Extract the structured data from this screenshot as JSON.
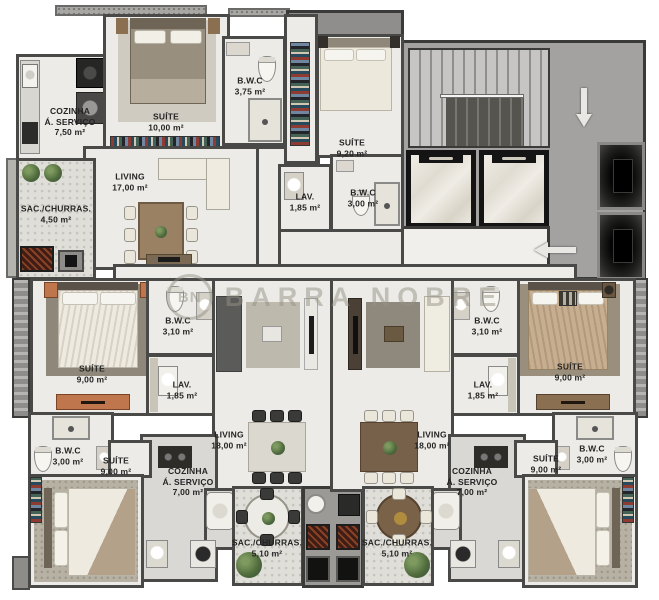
{
  "watermark": {
    "initials": "BN",
    "name": "BARRA NOBRE"
  },
  "rooms": {
    "a_cozinha": {
      "name": "COZINHA",
      "name2": "Á. SERVIÇO",
      "area": "7,50 m²"
    },
    "a_suite": {
      "name": "SUÍTE",
      "area": "10,00 m²"
    },
    "a_bwc": {
      "name": "B.W.C",
      "area": "3,75 m²"
    },
    "a_living": {
      "name": "LIVING",
      "area": "17,00 m²"
    },
    "a_sacada": {
      "name": "SAC./CHURRAS.",
      "area": "4,50 m²"
    },
    "b_suite": {
      "name": "SUÍTE",
      "area": "9,20 m²"
    },
    "b_lav": {
      "name": "LAV.",
      "area": "1,85 m²"
    },
    "b_bwc": {
      "name": "B.W.C",
      "area": "3,00 m²"
    },
    "c_suite1": {
      "name": "SUÍTE",
      "area": "9,00 m²"
    },
    "c_bwc1": {
      "name": "B.W.C",
      "area": "3,10 m²"
    },
    "c_lav": {
      "name": "LAV.",
      "area": "1,85 m²"
    },
    "c_living": {
      "name": "LIVING",
      "area": "18,00 m²"
    },
    "c_cozinha": {
      "name": "COZINHA",
      "name2": "Á. SERVIÇO",
      "area": "7,00 m²"
    },
    "c_sacada": {
      "name": "SAC./CHURRAS.",
      "area": "5,10 m²"
    },
    "c_suite2": {
      "name": "SUÍTE",
      "area": "9,00 m²"
    },
    "c_bwc2": {
      "name": "B.W.C",
      "area": "3,00 m²"
    },
    "d_bwc1": {
      "name": "B.W.C",
      "area": "3,10 m²"
    },
    "d_lav": {
      "name": "LAV.",
      "area": "1,85 m²"
    },
    "d_suite1": {
      "name": "SUÍTE",
      "area": "9,00 m²"
    },
    "d_living": {
      "name": "LIVING",
      "area": "18,00 m²"
    },
    "d_cozinha": {
      "name": "COZINHA",
      "name2": "Á. SERVIÇO",
      "area": "7,00 m²"
    },
    "d_sacada": {
      "name": "SAC./CHURRAS.",
      "area": "5,10 m²"
    },
    "d_suite2": {
      "name": "SUÍTE",
      "area": "9,00 m²"
    },
    "d_bwc2": {
      "name": "B.W.C",
      "area": "3,00 m²"
    }
  },
  "palette": {
    "background": "#FFFFFF",
    "floor": "#ECEBE7",
    "floor_kitchen": "#D9D8D4",
    "floor_balcony": "#DFDED8",
    "wall": "#494947",
    "core_gray": "#A3A2A0",
    "stair_light": "#C6C5C3",
    "stair_dark": "#55544F",
    "elevator_frame": "#141414",
    "marble": "#EFECE5",
    "shaft_dark": "#0A0A0A",
    "wood": "#9A8164",
    "terracotta": "#C0764C",
    "bed_linen": "#EFEAE0",
    "plant_green": "#5E7C49",
    "grill_brick": "#3D1D15",
    "label_text": "#242424",
    "watermark": "#B4AFA5"
  }
}
